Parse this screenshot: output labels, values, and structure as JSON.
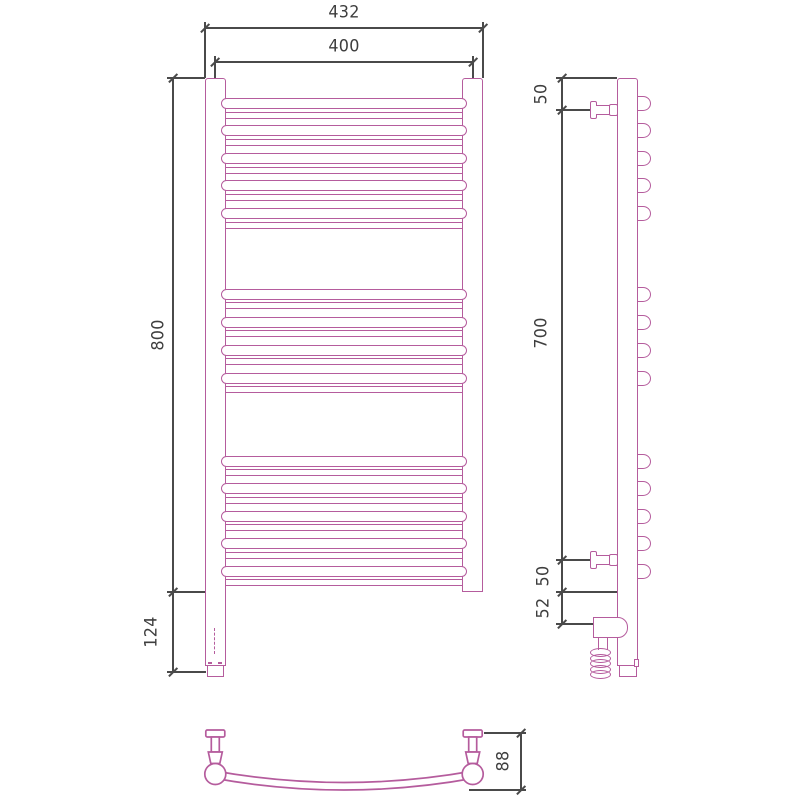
{
  "colors": {
    "product_outline": "#b55c9d",
    "dimension_lines": "#4a4a4a",
    "background": "#ffffff"
  },
  "dims": {
    "front": {
      "overall_width": "432",
      "axis_width": "400",
      "height": "800",
      "bottom_extension": "124"
    },
    "side": {
      "top_bracket": "50",
      "bracket_span": "700",
      "bottom_bracket": "50",
      "heater_drop": "52"
    },
    "plan": {
      "depth": "88"
    }
  }
}
